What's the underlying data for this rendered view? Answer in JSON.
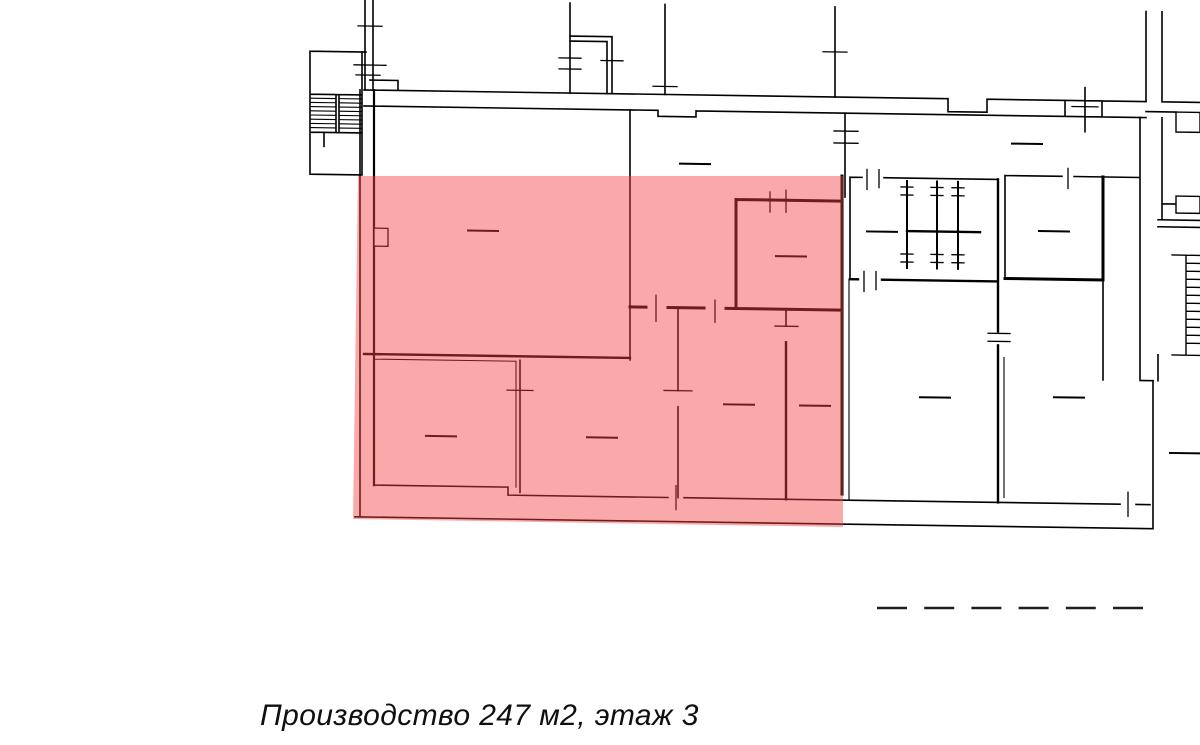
{
  "caption": {
    "text": "Производство 247 м2, этаж 3",
    "usage": "Производство",
    "area_m2": "247",
    "floor": "3"
  },
  "colors": {
    "highlight": "#F44044",
    "wall": "#000000",
    "background": "#ffffff",
    "legend_dash": "#1f1f1f"
  },
  "legend": {
    "dash_count": 6
  },
  "plan": {
    "type": "floor plan",
    "highlighted_zone": "production area",
    "room_label_placeholders": 13
  }
}
